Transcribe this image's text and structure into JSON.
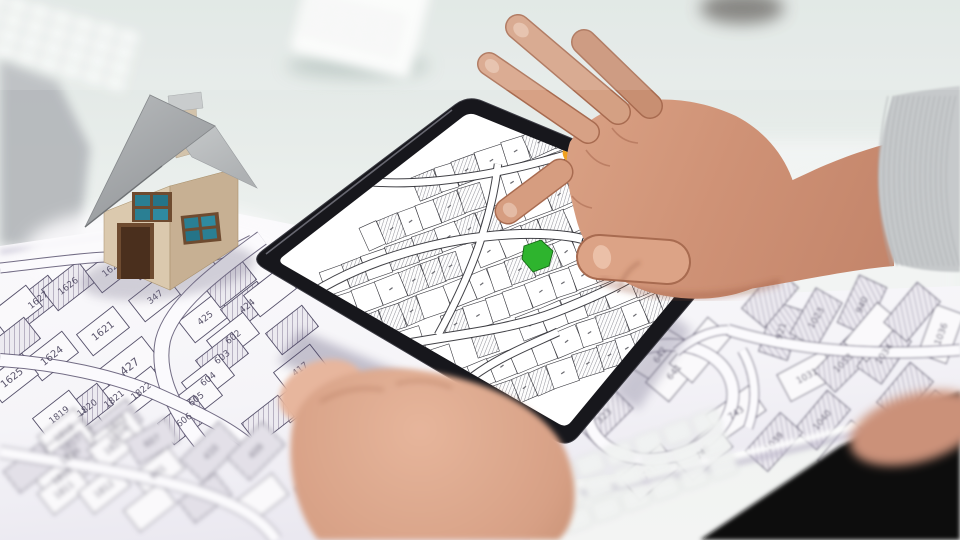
{
  "scene": {
    "subject": "Hands holding tablet showing cadastral parcel map over paper cadastral map with model house"
  },
  "colors": {
    "selected_parcel_green": "#2eb42e",
    "selected_parcel_border": "#156615",
    "marker_orange": "#f0a11e",
    "tablet_bezel": "#17171c",
    "screen_white": "#ffffff",
    "paper": "#f7f6f9",
    "parcel_line": "#55506a",
    "hatch_line": "#a49cb2",
    "skin": "#cf9276",
    "sleeve_gray": "#c6c9cb",
    "house_wall": "#dbc9ae",
    "house_roof": "#a2a5a8",
    "house_door": "#4a2f1d",
    "window_pane": "#2a7f93",
    "dark_clothing": "#0b0b0f"
  },
  "paper_map": {
    "parcels": [
      {
        "number": "1627",
        "x": 38,
        "y": 300,
        "hatch": true,
        "layer": "left"
      },
      {
        "number": "1626",
        "x": 68,
        "y": 286,
        "hatch": true,
        "layer": "left"
      },
      {
        "number": "1620",
        "x": 112,
        "y": 268,
        "layer": "left"
      },
      {
        "number": "347",
        "x": 155,
        "y": 297,
        "layer": "left"
      },
      {
        "number": "1621",
        "x": 103,
        "y": 331,
        "fs": 10,
        "layer": "left"
      },
      {
        "number": "425",
        "x": 205,
        "y": 318,
        "layer": "left"
      },
      {
        "number": "424",
        "x": 247,
        "y": 306,
        "hatch": true,
        "layer": "left"
      },
      {
        "number": "602",
        "x": 233,
        "y": 337,
        "layer": "left"
      },
      {
        "number": "1624",
        "x": 52,
        "y": 356,
        "fs": 10,
        "layer": "left"
      },
      {
        "number": "427",
        "x": 130,
        "y": 367,
        "fs": 11,
        "w": 56,
        "h": 34,
        "layer": "left"
      },
      {
        "number": "1625",
        "x": 12,
        "y": 378,
        "fs": 10,
        "layer": "left"
      },
      {
        "number": "603",
        "x": 222,
        "y": 357,
        "hatch": true,
        "layer": "left"
      },
      {
        "number": "604",
        "x": 208,
        "y": 379,
        "layer": "left"
      },
      {
        "number": "605",
        "x": 196,
        "y": 399,
        "layer": "left"
      },
      {
        "number": "606",
        "x": 184,
        "y": 420,
        "hatch": true,
        "layer": "left"
      },
      {
        "number": "417",
        "x": 300,
        "y": 369,
        "layer": "left"
      },
      {
        "number": "1822",
        "x": 141,
        "y": 391,
        "layer": "left"
      },
      {
        "number": "1821",
        "x": 114,
        "y": 399,
        "layer": "left"
      },
      {
        "number": "1820",
        "x": 87,
        "y": 408,
        "hatch": true,
        "layer": "left"
      },
      {
        "number": "1819",
        "x": 59,
        "y": 415,
        "layer": "left"
      },
      {
        "number": "",
        "x": 150,
        "y": 255,
        "hatch": true,
        "layer": "left"
      },
      {
        "number": "",
        "x": 192,
        "y": 272,
        "layer": "left"
      },
      {
        "number": "",
        "x": 230,
        "y": 283,
        "hatch": true,
        "layer": "left"
      },
      {
        "number": "",
        "x": 270,
        "y": 292,
        "layer": "left"
      },
      {
        "number": "",
        "x": 16,
        "y": 310,
        "layer": "left"
      },
      {
        "number": "",
        "x": 14,
        "y": 342,
        "hatch": true,
        "layer": "left"
      },
      {
        "number": "",
        "x": 292,
        "y": 330,
        "hatch": true,
        "layer": "left"
      },
      {
        "number": "",
        "x": 300,
        "y": 398,
        "layer": "left"
      },
      {
        "number": "",
        "x": 268,
        "y": 420,
        "hatch": true,
        "layer": "left"
      },
      {
        "number": "1818",
        "x": 64,
        "y": 433,
        "layer": "bottom"
      },
      {
        "number": "1823",
        "x": 116,
        "y": 424,
        "hatch": true,
        "layer": "bottom"
      },
      {
        "number": "1817",
        "x": 71,
        "y": 444,
        "layer": "bottom"
      },
      {
        "number": "1824",
        "x": 118,
        "y": 434,
        "layer": "bottom"
      },
      {
        "number": "1816",
        "x": 70,
        "y": 456,
        "hatch": true,
        "layer": "bottom"
      },
      {
        "number": "1825",
        "x": 114,
        "y": 446,
        "layer": "bottom"
      },
      {
        "number": "607",
        "x": 152,
        "y": 441,
        "rot": -30,
        "hatch": true,
        "layer": "bottom"
      },
      {
        "number": "601",
        "x": 158,
        "y": 472,
        "layer": "bottom"
      },
      {
        "number": "410",
        "x": 211,
        "y": 452,
        "rot": -45,
        "hatch": true,
        "w": 54,
        "h": 32,
        "layer": "bottom"
      },
      {
        "number": "409",
        "x": 256,
        "y": 451,
        "rot": -45,
        "hatch": true,
        "w": 50,
        "h": 32,
        "layer": "bottom"
      },
      {
        "number": "1810",
        "x": 62,
        "y": 476,
        "layer": "bottom"
      },
      {
        "number": "1811",
        "x": 64,
        "y": 490,
        "layer": "bottom"
      },
      {
        "number": "1812",
        "x": 104,
        "y": 489,
        "layer": "bottom"
      },
      {
        "number": "",
        "x": 30,
        "y": 468,
        "hatch": true,
        "layer": "bottom"
      },
      {
        "number": "",
        "x": 150,
        "y": 507,
        "layer": "bottom"
      },
      {
        "number": "",
        "x": 205,
        "y": 498,
        "hatch": true,
        "layer": "bottom"
      },
      {
        "number": "",
        "x": 262,
        "y": 498,
        "layer": "bottom"
      },
      {
        "number": "",
        "x": 322,
        "y": 485,
        "hatch": true,
        "layer": "bottom"
      },
      {
        "number": "",
        "x": 378,
        "y": 472,
        "layer": "bottom"
      },
      {
        "number": "",
        "x": 432,
        "y": 486,
        "hatch": true,
        "layer": "bottom"
      },
      {
        "number": "",
        "x": 480,
        "y": 506,
        "layer": "bottom"
      },
      {
        "number": "642",
        "x": 660,
        "y": 355,
        "rot": -58,
        "layer": "right"
      },
      {
        "number": "641",
        "x": 674,
        "y": 372,
        "layer": "right"
      },
      {
        "number": "921",
        "x": 781,
        "y": 331,
        "rot": -72,
        "hatch": true,
        "layer": "right"
      },
      {
        "number": "1023",
        "x": 816,
        "y": 318,
        "rot": -60,
        "hatch": true,
        "layer": "right"
      },
      {
        "number": "940",
        "x": 862,
        "y": 305,
        "rot": -65,
        "hatch": true,
        "layer": "right"
      },
      {
        "number": "1031",
        "x": 807,
        "y": 376,
        "rot": -28,
        "layer": "right"
      },
      {
        "number": "1033",
        "x": 843,
        "y": 363,
        "rot": -45,
        "hatch": true,
        "layer": "right"
      },
      {
        "number": "1034",
        "x": 884,
        "y": 354,
        "rot": -55,
        "hatch": true,
        "layer": "right"
      },
      {
        "number": "1036",
        "x": 941,
        "y": 334,
        "rot": -70,
        "layer": "right"
      },
      {
        "number": "323",
        "x": 604,
        "y": 416,
        "rot": -45,
        "hatch": true,
        "layer": "right"
      },
      {
        "number": "743",
        "x": 736,
        "y": 413,
        "rot": -35,
        "layer": "right"
      },
      {
        "number": "1040",
        "x": 822,
        "y": 420,
        "hatch": true,
        "layer": "right"
      },
      {
        "number": "1039",
        "x": 774,
        "y": 442,
        "rot": -48,
        "hatch": true,
        "layer": "right"
      },
      {
        "number": "741",
        "x": 650,
        "y": 472,
        "rot": -40,
        "layer": "right"
      },
      {
        "number": "742",
        "x": 703,
        "y": 452,
        "rot": -40,
        "layer": "right"
      },
      {
        "number": "143",
        "x": 846,
        "y": 450,
        "layer": "right"
      },
      {
        "number": "",
        "x": 700,
        "y": 350,
        "w": 60,
        "layer": "right"
      },
      {
        "number": "",
        "x": 905,
        "y": 392,
        "hatch": true,
        "layer": "right"
      },
      {
        "number": "",
        "x": 930,
        "y": 420,
        "layer": "right"
      },
      {
        "number": "",
        "x": 770,
        "y": 298,
        "hatch": true,
        "layer": "right"
      },
      {
        "number": "",
        "x": 872,
        "y": 332,
        "layer": "right"
      },
      {
        "number": "",
        "x": 912,
        "y": 312,
        "hatch": true,
        "layer": "right"
      }
    ]
  },
  "tablet_screen": {
    "selected_parcel": "green highlighted parcel",
    "marker": "orange map marker"
  }
}
